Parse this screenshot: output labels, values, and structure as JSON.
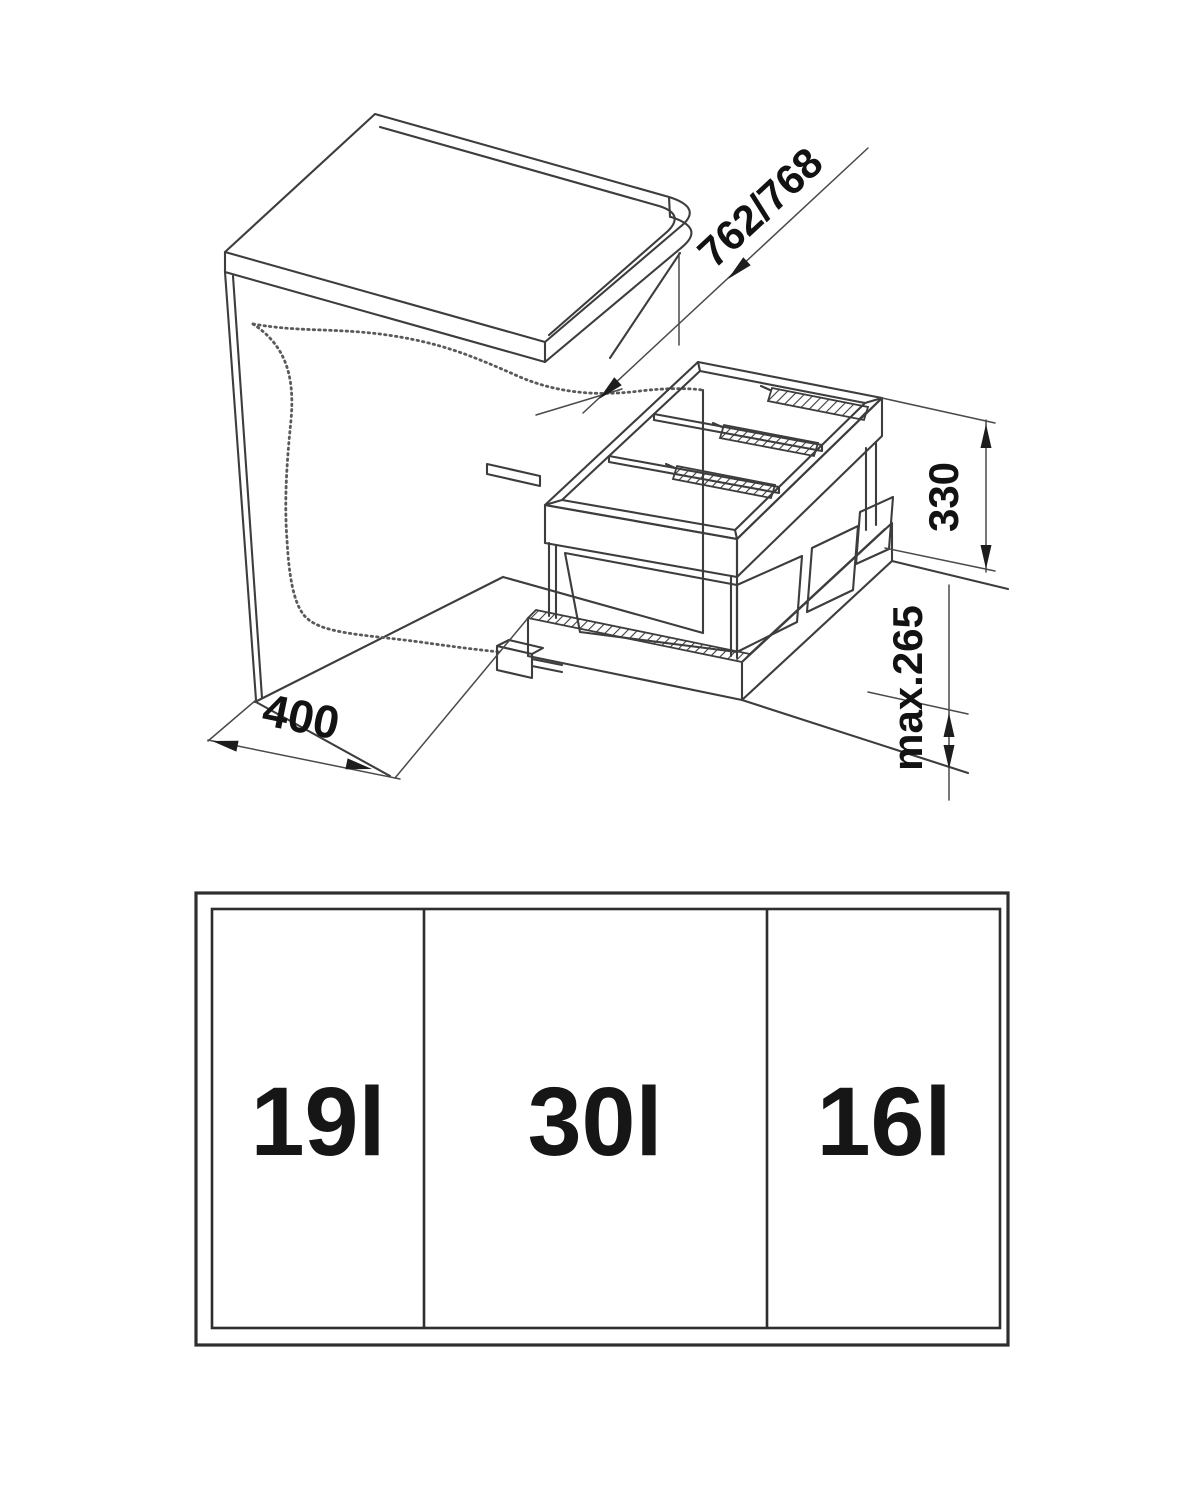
{
  "diagram": {
    "dimension_labels": {
      "depth": "762/768",
      "bin_height": "330",
      "max_height": "max.265",
      "width": "400"
    }
  },
  "top_view": {
    "compartments": [
      {
        "label": "19l"
      },
      {
        "label": "30l"
      },
      {
        "label": "16l"
      }
    ]
  },
  "colors": {
    "line": "#3d3d3d",
    "text": "#141414",
    "background": "#ffffff"
  }
}
